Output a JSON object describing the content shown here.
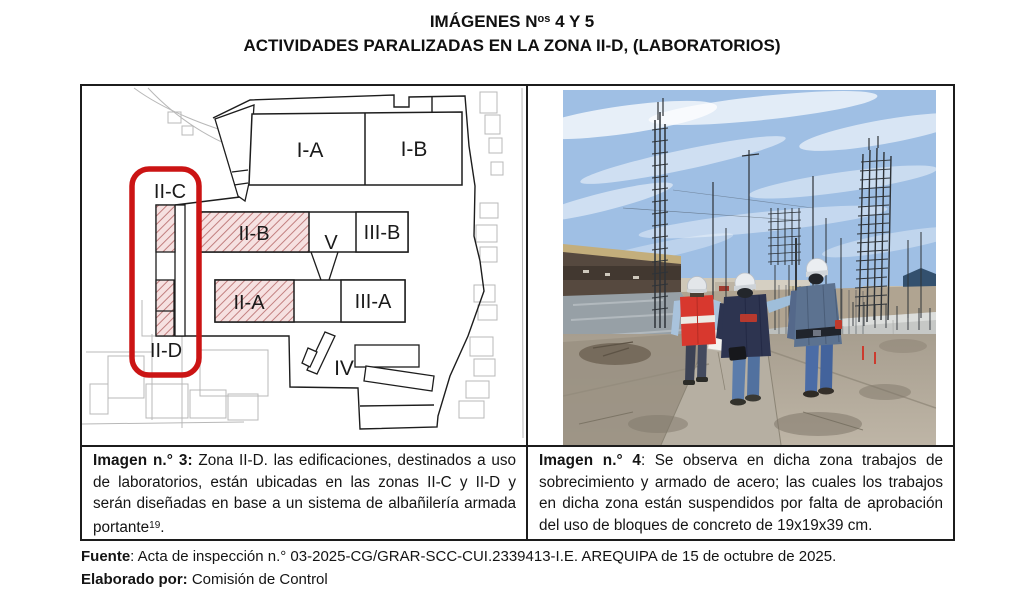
{
  "title": {
    "line1_prefix": "IMÁGENES N",
    "line1_sup": "os",
    "line1_suffix": " 4 Y 5",
    "line2": "ACTIVIDADES PARALIZADAS EN LA ZONA II-D, (LABORATORIOS)"
  },
  "plan": {
    "labels": {
      "ia": "I-A",
      "ib": "I-B",
      "iib": "II-B",
      "iiib": "III-B",
      "iia": "II-A",
      "iiia": "III-A",
      "v": "V",
      "iv": "IV",
      "iic": "II-C",
      "iid": "II-D"
    },
    "highlight_color": "#cb1414",
    "hatch_bg": "#f6e1e1",
    "hatch_line_color": "#c27f7f"
  },
  "captions": {
    "left": {
      "label": "Imagen n.° 3:",
      "body": " Zona II-D. las edificaciones, destinados a uso de laboratorios, están ubicadas en las zonas II-C y II-D y serán diseñadas en base a un sistema de albañilería armada portante",
      "sup": "19",
      "tail": "."
    },
    "right": {
      "label": "Imagen n.° 4",
      "body": ": Se observa en dicha zona trabajos de sobrecimiento y armado de acero; las cuales los trabajos en dicha zona están suspendidos por falta de aprobación del uso de bloques de concreto de 19x19x39 cm."
    }
  },
  "footer": {
    "fuente_label": "Fuente",
    "fuente_text": ": Acta de inspección n.° 03-2025-CG/GRAR-SCC-CUI.2339413-I.E. AREQUIPA de 15 de octubre de 2025.",
    "elaborado_label": "Elaborado por:",
    "elaborado_text": " Comisión de Control"
  }
}
